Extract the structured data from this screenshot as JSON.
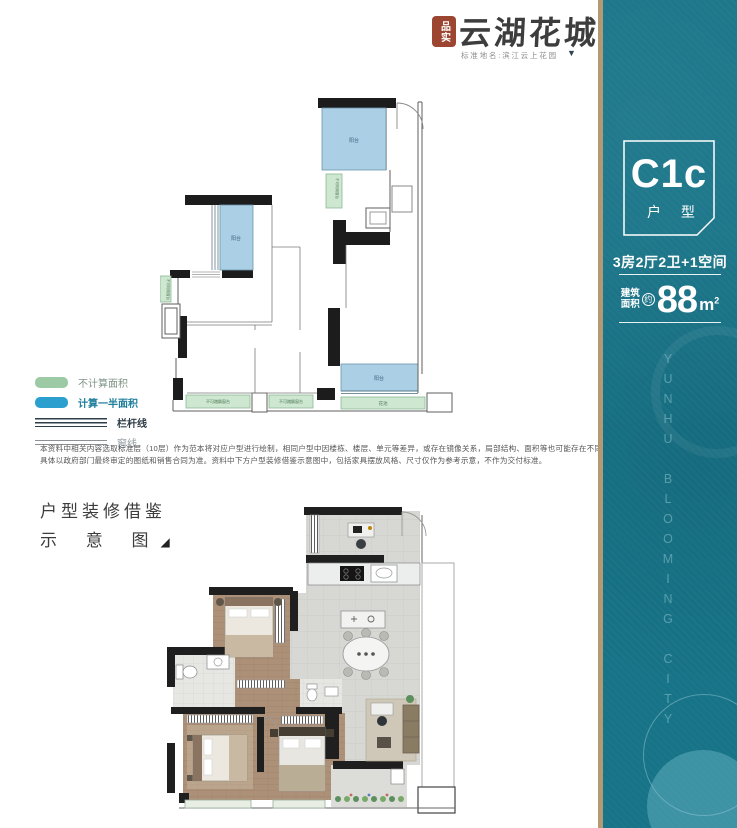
{
  "logo": {
    "seal_text": "品实",
    "brand": "云湖花城",
    "subtitle": "标准地名:滨江云上花园",
    "arrow": "▼"
  },
  "banner": {
    "bg": "#177387",
    "edge_color": "#b49a74",
    "code": "C1c",
    "code_label": "户 型",
    "layout": "3房2厅2卫+1空间",
    "area_label_top": "建筑",
    "area_label_bottom": "面积",
    "area_approx": "约",
    "area_value": "88",
    "area_unit": "m",
    "area_sup": "2",
    "vertical_text": "YUNHU BLOOMING CITY"
  },
  "legend": {
    "green": "#9ccaa4",
    "blue": "#2ba0cf",
    "items": [
      {
        "label": "不计算面积"
      },
      {
        "label": "计算一半面积"
      },
      {
        "label": "栏杆线"
      },
      {
        "label": "窗线"
      }
    ]
  },
  "disclaimer": "本资料中相关内容选取标准层（10层）作为范本将对应户型进行绘制，相同户型中因楼栋、楼层、单元等差异，或存在镜像关系，局部结构、面积等也可能存在不同，具体以政府部门最终审定的图纸和销售合同为准。资料中下方户型装修借鉴示意图中，包括家具摆放风格、尺寸仅作为参考示意，不作为交付标准。",
  "section": {
    "line1": "户型装修借鉴",
    "line2": "示 意 图",
    "marker": "◢"
  },
  "floorplan_top": {
    "balcony_top": "阳台",
    "balcony_left": "阳台",
    "balcony_bottom": "阳台",
    "flower_bed": "花池",
    "bay_window_left": "不可踏飘窗台",
    "bay_window_mid": "不可踏飘窗台",
    "duct_label": "不可利用窗台",
    "side_label": "不可利用窗台"
  }
}
